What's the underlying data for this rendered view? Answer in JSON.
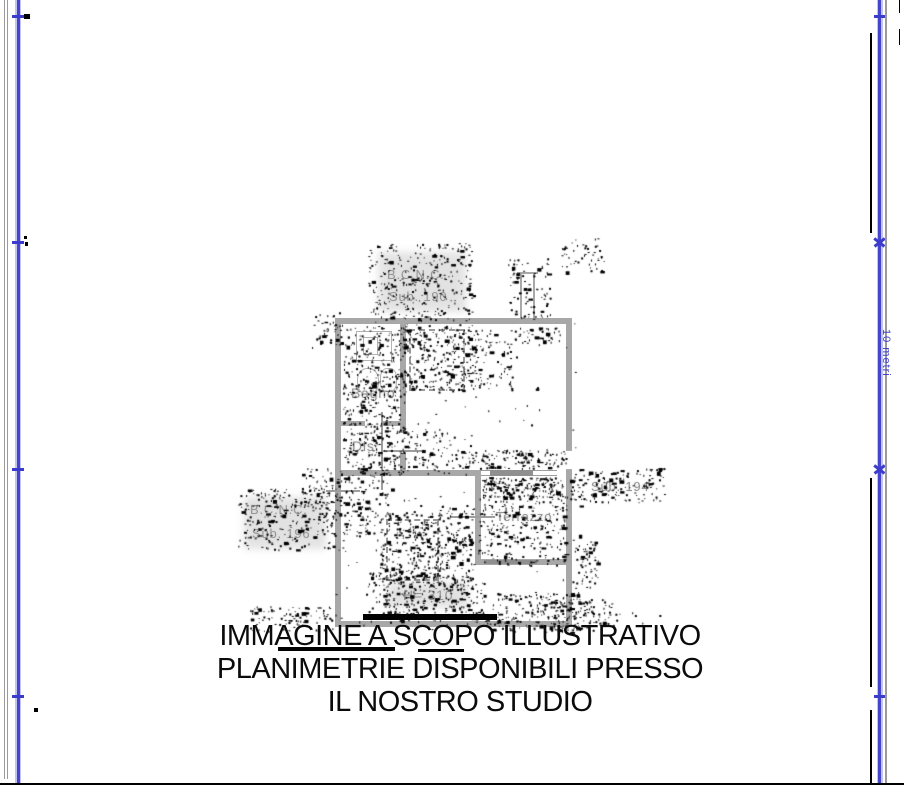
{
  "scale_bar": {
    "label": "10 metri"
  },
  "floor_plan": {
    "labels": {
      "bcnc_top_line1": "B.C.N.C.",
      "bcnc_top_line2": "Sub. 190",
      "bagno": "Bagno",
      "dis": "Dis.",
      "terrazzo": "Terrazzo",
      "sub_194": "Sub. 194",
      "bcnc_left_line1": "B.C.N.C.",
      "bcnc_left_line2": "Sub. 196",
      "height_note": "H= 310"
    }
  },
  "watermark": {
    "line1": "IMMAGINE A SCOPO ILLUSTRATIVO",
    "line2": "PLANIMETRIE DISPONIBILI PRESSO",
    "line3": "IL NOSTRO STUDIO"
  },
  "colors": {
    "accent_blue": "#4444cf",
    "wall_gray": "#a8a8a8",
    "label_gray": "#969696",
    "ink_black": "#000000"
  }
}
